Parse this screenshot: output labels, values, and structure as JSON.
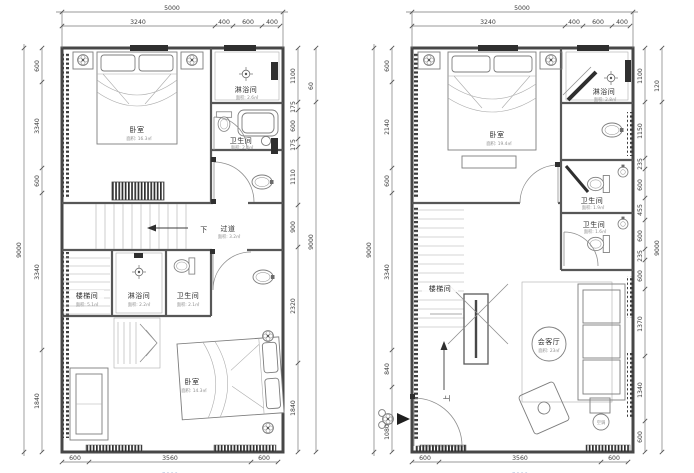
{
  "left_plan": {
    "dims": {
      "top_overall": "5000",
      "top": [
        "3240",
        "400",
        "600",
        "400"
      ],
      "left_overall": "9000",
      "left": [
        "600",
        "3340",
        "600",
        "3340",
        "1840"
      ],
      "right": [
        "1100",
        "175",
        "600",
        "175",
        "1110",
        "900",
        "2320",
        "1840"
      ],
      "right_outer_small": "60",
      "right_overall": "9000",
      "bottom": [
        "600",
        "3560",
        "600"
      ],
      "bottom_overall": "5000"
    },
    "rooms": {
      "bedroom_top": {
        "label": "卧室",
        "area": "面积: 16.3㎡"
      },
      "shower_top": {
        "label": "淋浴间",
        "area": "面积: 2.6㎡"
      },
      "wc_top": {
        "label": "卫生间",
        "area": "面积: 2.4㎡"
      },
      "corridor": {
        "label": "过道",
        "area": "面积: 3.2㎡"
      },
      "down_label": "下",
      "stair_room": {
        "label": "楼梯间",
        "area": "面积: 5.1㎡"
      },
      "shower_bottom": {
        "label": "淋浴间",
        "area": "面积: 2.2㎡"
      },
      "wc_bottom": {
        "label": "卫生间",
        "area": "面积: 2.1㎡"
      },
      "bedroom_bottom": {
        "label": "卧室",
        "area": "面积: 14.3㎡"
      }
    }
  },
  "right_plan": {
    "dims": {
      "top_overall": "5000",
      "top": [
        "3240",
        "400",
        "600",
        "400"
      ],
      "left_overall": "9000",
      "left": [
        "600",
        "2140",
        "600",
        "3340",
        "840",
        "1080"
      ],
      "right": [
        "1100",
        "1150",
        "235",
        "600",
        "455",
        "600",
        "235",
        "600",
        "1370",
        "1340",
        "600"
      ],
      "right_outer_small": "120",
      "right_overall": "9000",
      "bottom": [
        "600",
        "3560",
        "600"
      ],
      "bottom_overall": "5000"
    },
    "rooms": {
      "bedroom": {
        "label": "卧室",
        "area": "面积: 19.4㎡"
      },
      "shower": {
        "label": "淋浴间",
        "area": "面积: 2.8㎡"
      },
      "wc_upper": {
        "label": "卫生间",
        "area": "面积: 1.9㎡"
      },
      "wc_lower": {
        "label": "卫生间",
        "area": "面积: 1.6㎡"
      },
      "stair_room": {
        "label": "楼梯间"
      },
      "living": {
        "label": "会客厅",
        "area": "面积: 23㎡"
      },
      "up_label": "上",
      "ac_label": "空调"
    }
  }
}
